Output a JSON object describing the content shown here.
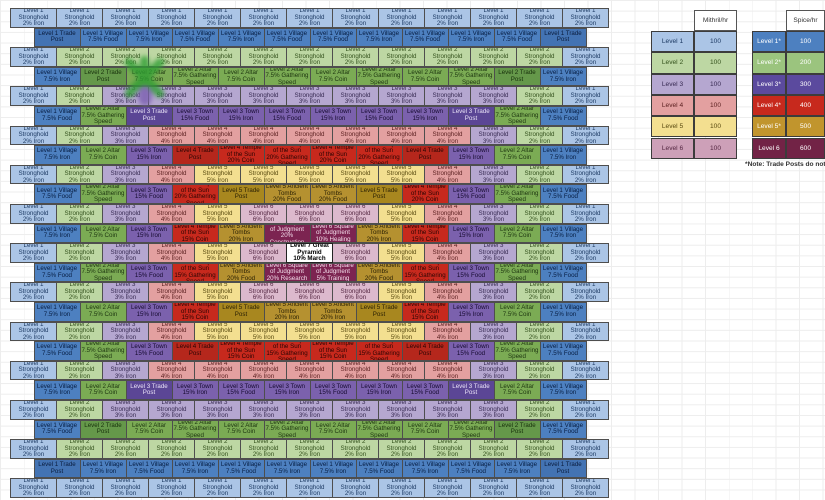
{
  "cell_types": {
    "sh1": {
      "label": "Level 1 Stronghold",
      "sub": "2% Iron",
      "bg": "#abc5e6",
      "fg": "#1d3a63"
    },
    "sh2": {
      "label": "Level 2 Stronghold",
      "sub": "2% Iron",
      "bg": "#bdd7a3",
      "fg": "#33511c"
    },
    "sh3": {
      "label": "Level 3 Stronghold",
      "sub": "3% Iron",
      "bg": "#b5a7d0",
      "fg": "#372a52"
    },
    "sh4": {
      "label": "Level 4 Stronghold",
      "sub": "4% Iron",
      "bg": "#e3a0a0",
      "fg": "#5a1f1f"
    },
    "sh5": {
      "label": "Level 5 Stronghold",
      "sub": "5% Iron",
      "bg": "#f3df90",
      "fg": "#594a10"
    },
    "sh6": {
      "label": "Level 6 Stronghold",
      "sub": "6% Iron",
      "bg": "#dcb9cd",
      "fg": "#542742"
    },
    "vf": {
      "label": "Level 1 Village",
      "sub": "7.5% Food",
      "bg": "#4d80c0",
      "fg": "#071d42"
    },
    "vi": {
      "label": "Level 1 Village",
      "sub": "7.5% Iron",
      "bg": "#4d80c0",
      "fg": "#071d42"
    },
    "tp1": {
      "label": "Level 1 Trade Post",
      "sub": "",
      "bg": "#4373b3",
      "fg": "#0a1c3d"
    },
    "tp2": {
      "label": "Level 2 Trade Post",
      "sub": "",
      "bg": "#65984a",
      "fg": "#17300c"
    },
    "ac": {
      "label": "Level 2 Altar",
      "sub": "7.5% Coin",
      "bg": "#7bab54",
      "fg": "#1d3510"
    },
    "ag": {
      "label": "Level 2 Altar",
      "sub": "7.5% Gathering Speed",
      "bg": "#7bab54",
      "fg": "#1d3510"
    },
    "tp3": {
      "label": "Level 3 Trade Post",
      "sub": "",
      "bg": "#5b4695",
      "fg": "#e9e2f7"
    },
    "tf": {
      "label": "Level 3 Town",
      "sub": "15% Food",
      "bg": "#7b61ad",
      "fg": "#160b30"
    },
    "ti": {
      "label": "Level 3 Town",
      "sub": "15% Iron",
      "bg": "#7b61ad",
      "fg": "#160b30"
    },
    "tp4": {
      "label": "Level 4 Trade Post",
      "sub": "",
      "bg": "#b5271c",
      "fg": "#2b0503"
    },
    "tc20": {
      "label": "Level 4 Temple of the Sun",
      "sub": "20% Coin",
      "bg": "#c7291d",
      "fg": "#2b0503"
    },
    "tg20": {
      "label": "Level 4 Temple of the Sun",
      "sub": "20% Gathering Speed",
      "bg": "#c7291d",
      "fg": "#2b0503"
    },
    "tc15": {
      "label": "Level 4 Temple of the Sun",
      "sub": "15% Coin",
      "bg": "#c7291d",
      "fg": "#2b0503"
    },
    "tg15": {
      "label": "Level 4 Temple of the Sun",
      "sub": "15% Gathering Speed",
      "bg": "#c7291d",
      "fg": "#2b0503"
    },
    "tp5": {
      "label": "Level 5 Trade Post",
      "sub": "",
      "bg": "#a8871f",
      "fg": "#2b2104"
    },
    "tof": {
      "label": "Level 5 Ancient Tombs",
      "sub": "20% Food",
      "bg": "#b59130",
      "fg": "#2b2104"
    },
    "toi": {
      "label": "Level 5 Ancient Tombs",
      "sub": "20% Iron",
      "bg": "#b59130",
      "fg": "#2b2104"
    },
    "sjc": {
      "label": "Level 6 Square of Judgment",
      "sub": "20% Construction",
      "bg": "#7c2451",
      "fg": "#f3dcea"
    },
    "sjh": {
      "label": "Level 6 Square of Judgment",
      "sub": "10% Healing",
      "bg": "#7c2451",
      "fg": "#f3dcea"
    },
    "sjr": {
      "label": "Level 6 Square of Judgment",
      "sub": "20% Research",
      "bg": "#7c2451",
      "fg": "#f3dcea"
    },
    "sjt": {
      "label": "Level 6 Square of Judgment",
      "sub": "5% Training",
      "bg": "#7c2451",
      "fg": "#f3dcea"
    },
    "pyr": {
      "label": "Level 7 Great Pyramid",
      "sub": "10% March",
      "bg": "#ffffff",
      "fg": "#000000"
    }
  },
  "grid": {
    "rows": [
      {
        "offset": false,
        "cells": [
          "sh1",
          "sh1",
          "sh1",
          "sh1",
          "sh1",
          "sh1",
          "sh1",
          "sh1",
          "sh1",
          "sh1",
          "sh1",
          "sh1",
          "sh1"
        ]
      },
      {
        "offset": true,
        "cells": [
          "tp1",
          "vf",
          "vi",
          "vf",
          "vi",
          "vf",
          "vf",
          "vi",
          "vf",
          "vi",
          "vf",
          "tp1"
        ]
      },
      {
        "offset": false,
        "cells": [
          "sh1",
          "sh2",
          "sh2",
          "sh2",
          "sh2",
          "sh2",
          "sh2",
          "sh2",
          "sh2",
          "sh2",
          "sh2",
          "sh2",
          "sh1"
        ]
      },
      {
        "offset": true,
        "cells": [
          "vi",
          "tp2",
          "ac",
          "ag",
          "ac",
          "ag",
          "ac",
          "ag",
          "ac",
          "ag",
          "tp2",
          "vi"
        ]
      },
      {
        "offset": false,
        "cells": [
          "sh1",
          "sh2",
          "sh3",
          "sh3",
          "sh3",
          "sh3",
          "sh3",
          "sh3",
          "sh3",
          "sh3",
          "sh3",
          "sh2",
          "sh1"
        ]
      },
      {
        "offset": true,
        "cells": [
          "vf",
          "ag",
          "tp3",
          "tf",
          "ti",
          "tf",
          "ti",
          "tf",
          "ti",
          "tp3",
          "ag",
          "vf"
        ]
      },
      {
        "offset": false,
        "cells": [
          "sh1",
          "sh2",
          "sh3",
          "sh4",
          "sh4",
          "sh4",
          "sh4",
          "sh4",
          "sh4",
          "sh4",
          "sh3",
          "sh2",
          "sh1"
        ]
      },
      {
        "offset": true,
        "cells": [
          "vi",
          "ac",
          "ti",
          "tp4",
          "tc20",
          "tg20",
          "tc20",
          "tg20",
          "tp4",
          "ti",
          "ac",
          "vi"
        ]
      },
      {
        "offset": false,
        "cells": [
          "sh1",
          "sh2",
          "sh3",
          "sh4",
          "sh5",
          "sh5",
          "sh5",
          "sh5",
          "sh5",
          "sh4",
          "sh3",
          "sh2",
          "sh1"
        ]
      },
      {
        "offset": true,
        "cells": [
          "vf",
          "ag",
          "tf",
          "tg20",
          "tp5",
          "tof",
          "tof",
          "tp5",
          "tc20",
          "tf",
          "ag",
          "vf"
        ]
      },
      {
        "offset": false,
        "cells": [
          "sh1",
          "sh2",
          "sh3",
          "sh4",
          "sh5",
          "sh6",
          "sh6",
          "sh6",
          "sh5",
          "sh4",
          "sh3",
          "sh2",
          "sh1"
        ]
      },
      {
        "offset": true,
        "cells": [
          "vi",
          "ac",
          "ti",
          "tc15",
          "toi",
          "sjc",
          "sjh",
          "toi",
          "tc15",
          "ti",
          "ac",
          "vi"
        ]
      },
      {
        "offset": false,
        "cells": [
          "sh1",
          "sh2",
          "sh3",
          "sh4",
          "sh5",
          "sh6",
          "pyr",
          "sh6",
          "sh5",
          "sh4",
          "sh3",
          "sh2",
          "sh1"
        ]
      },
      {
        "offset": true,
        "cells": [
          "vf",
          "ag",
          "tf",
          "tg15",
          "tof",
          "sjr",
          "sjt",
          "tof",
          "tg15",
          "tf",
          "ag",
          "vf"
        ]
      },
      {
        "offset": false,
        "cells": [
          "sh1",
          "sh2",
          "sh3",
          "sh4",
          "sh5",
          "sh6",
          "sh6",
          "sh6",
          "sh5",
          "sh4",
          "sh3",
          "sh2",
          "sh1"
        ]
      },
      {
        "offset": true,
        "cells": [
          "vi",
          "ac",
          "ti",
          "tc15",
          "tp5",
          "toi",
          "toi",
          "tp5",
          "tc15",
          "ti",
          "ac",
          "vi"
        ]
      },
      {
        "offset": false,
        "cells": [
          "sh1",
          "sh2",
          "sh3",
          "sh4",
          "sh5",
          "sh5",
          "sh5",
          "sh5",
          "sh5",
          "sh4",
          "sh3",
          "sh2",
          "sh1"
        ]
      },
      {
        "offset": true,
        "cells": [
          "vf",
          "ag",
          "tf",
          "tp4",
          "tc15",
          "tg15",
          "tc15",
          "tg15",
          "tp4",
          "tf",
          "ag",
          "vf"
        ]
      },
      {
        "offset": false,
        "cells": [
          "sh1",
          "sh2",
          "sh3",
          "sh4",
          "sh4",
          "sh4",
          "sh4",
          "sh4",
          "sh4",
          "sh4",
          "sh3",
          "sh2",
          "sh1"
        ]
      },
      {
        "offset": true,
        "cells": [
          "vi",
          "ac",
          "tp3",
          "ti",
          "tf",
          "ti",
          "tf",
          "ti",
          "tf",
          "tp3",
          "ac",
          "vi"
        ]
      },
      {
        "offset": false,
        "cells": [
          "sh1",
          "sh2",
          "sh3",
          "sh3",
          "sh3",
          "sh3",
          "sh3",
          "sh3",
          "sh3",
          "sh3",
          "sh3",
          "sh2",
          "sh1"
        ]
      },
      {
        "offset": true,
        "cells": [
          "vf",
          "tp2",
          "ac",
          "ag",
          "ac",
          "ag",
          "ac",
          "ag",
          "ac",
          "ag",
          "tp2",
          "vf"
        ]
      },
      {
        "offset": false,
        "cells": [
          "sh1",
          "sh2",
          "sh2",
          "sh2",
          "sh2",
          "sh2",
          "sh2",
          "sh2",
          "sh2",
          "sh2",
          "sh2",
          "sh2",
          "sh1"
        ]
      },
      {
        "offset": true,
        "cells": [
          "tp1",
          "vi",
          "vf",
          "vi",
          "vf",
          "vi",
          "vi",
          "vf",
          "vi",
          "vf",
          "vi",
          "tp1"
        ]
      },
      {
        "offset": false,
        "cells": [
          "sh1",
          "sh1",
          "sh1",
          "sh1",
          "sh1",
          "sh1",
          "sh1",
          "sh1",
          "sh1",
          "sh1",
          "sh1",
          "sh1",
          "sh1"
        ]
      }
    ]
  },
  "legend": {
    "left": {
      "header": "Mithril/hr",
      "rows": [
        {
          "label": "Level 1",
          "value": "100",
          "bg": "#abc5e6",
          "fg": "#1d3a63"
        },
        {
          "label": "Level 2",
          "value": "100",
          "bg": "#bdd7a3",
          "fg": "#33511c"
        },
        {
          "label": "Level 3",
          "value": "100",
          "bg": "#b5a7d0",
          "fg": "#372a52"
        },
        {
          "label": "Level 4",
          "value": "100",
          "bg": "#e3a0a0",
          "fg": "#5a1f1f"
        },
        {
          "label": "Level 5",
          "value": "100",
          "bg": "#f3df90",
          "fg": "#594a10"
        },
        {
          "label": "Level 6",
          "value": "100",
          "bg": "#cda0b8",
          "fg": "#542742"
        }
      ]
    },
    "right": {
      "header": "Spice/hr",
      "rows": [
        {
          "label": "Level 1*",
          "value": "100",
          "bg": "#4d80c0",
          "fg": "#ffffff"
        },
        {
          "label": "Level 2*",
          "value": "200",
          "bg": "#9bc47e",
          "fg": "#ffffff"
        },
        {
          "label": "Level 3*",
          "value": "300",
          "bg": "#5b4a9e",
          "fg": "#ffffff"
        },
        {
          "label": "Level 4*",
          "value": "400",
          "bg": "#c7291d",
          "fg": "#ffffff"
        },
        {
          "label": "Level 5*",
          "value": "500",
          "bg": "#c1952d",
          "fg": "#ffffff"
        },
        {
          "label": "Level 6",
          "value": "600",
          "bg": "#722346",
          "fg": "#ffffff"
        }
      ]
    },
    "note": "*Note: Trade Posts do not produ"
  }
}
